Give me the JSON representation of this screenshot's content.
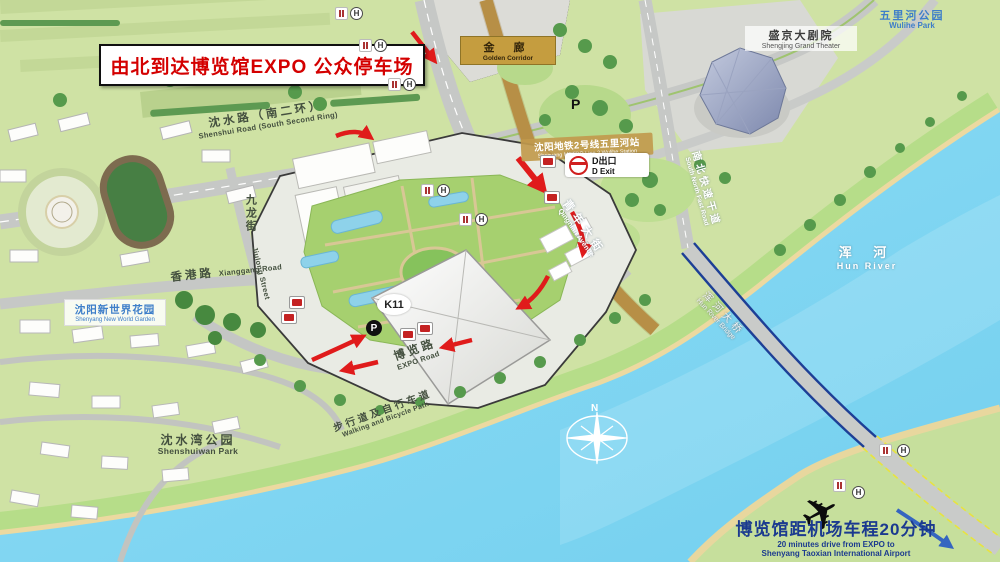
{
  "banner": {
    "text": "由北到达博览馆EXPO 公众停车场"
  },
  "places": {
    "golden_corridor": {
      "zh": "金 廊",
      "en": "Golden Corridor"
    },
    "shengjing_theater": {
      "zh": "盛京大剧院",
      "en": "Shengjing Grand Theater"
    },
    "wulihe_park": {
      "zh": "五里河公园",
      "en": "Wulihe Park"
    },
    "new_world_garden": {
      "zh": "沈阳新世界花园",
      "en": "Shenyang New World Garden"
    },
    "shenshuiwan_park": {
      "zh": "沈水湾公园",
      "en": "Shenshuiwan Park"
    },
    "hun_river": {
      "zh": "浑 河",
      "en": "Hun River"
    },
    "k11": {
      "label": "K11"
    }
  },
  "roads": {
    "shenshui": {
      "zh": "沈水路（南二环）",
      "en": "Shenshui Road (South Second Ring)"
    },
    "qingnian": {
      "zh": "青年大街",
      "en": "Qingnian Avenue"
    },
    "south_north": {
      "zh": "南北快速干道",
      "en": "South North Fast Road"
    },
    "jiulong": {
      "zh": "九龙街",
      "en": "Jiulong Street"
    },
    "xianggang": {
      "zh": "香港路",
      "en": "Xianggang Road"
    },
    "expo": {
      "zh": "博览路",
      "en": "EXPO Road"
    },
    "bridge": {
      "zh": "浑河大桥",
      "en": "Hun River Bridge"
    },
    "walking": {
      "zh": "步行道及自行车道",
      "en": "Walking and Bicycle Path"
    }
  },
  "transit": {
    "metro_station": {
      "zh": "沈阳地铁2号线五里河站",
      "en": "Shenyang METRO Line 2 Wulihe Station"
    },
    "d_exit": {
      "zh": "D出口",
      "en": "D Exit"
    }
  },
  "airport": {
    "zh": "博览馆距机场车程20分钟",
    "en_line1": "20 minutes drive from EXPO to",
    "en_line2": "Shenyang Taoxian International Airport"
  },
  "icons": {
    "parking": "P",
    "hotel": "H",
    "compass_north": "N"
  },
  "colors": {
    "route_arrow": "#e01b1b",
    "banner_text": "#d40000",
    "water": "#82d7f2",
    "gold_road": "#c59a4e",
    "navy_text": "#1b3a8f",
    "sand": "#ecd9a0"
  }
}
